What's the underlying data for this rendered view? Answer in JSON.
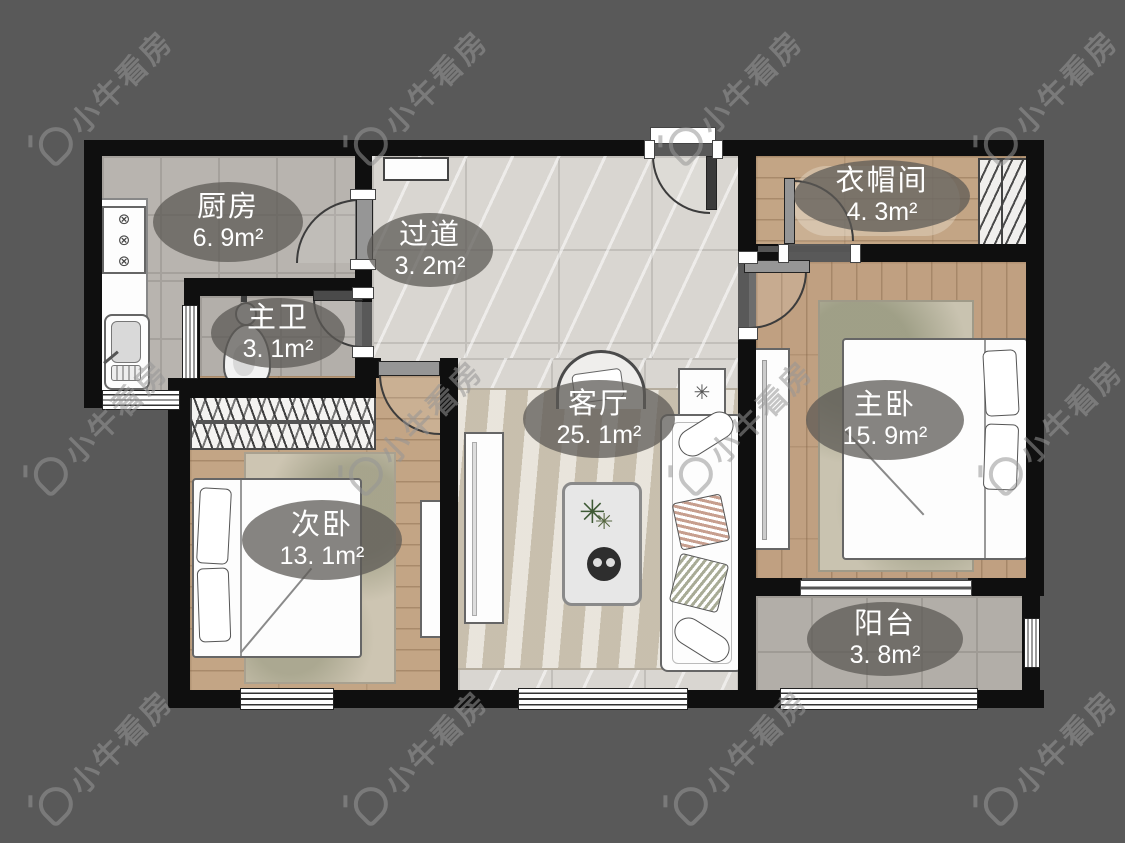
{
  "watermark": {
    "text": "小牛看房"
  },
  "rooms": [
    {
      "id": "kitchen",
      "name": "厨房",
      "area": "6. 9m²"
    },
    {
      "id": "hallway",
      "name": "过道",
      "area": "3. 2m²"
    },
    {
      "id": "master-bath",
      "name": "主卫",
      "area": "3. 1m²"
    },
    {
      "id": "cloakroom",
      "name": "衣帽间",
      "area": "4. 3m²"
    },
    {
      "id": "living-room",
      "name": "客厅",
      "area": "25. 1m²"
    },
    {
      "id": "master-bedroom",
      "name": "主卧",
      "area": "15. 9m²"
    },
    {
      "id": "second-bedroom",
      "name": "次卧",
      "area": "13. 1m²"
    },
    {
      "id": "balcony",
      "name": "阳台",
      "area": "3. 8m²"
    }
  ],
  "decor": {
    "coffee_table_plant": "✳",
    "flower_box": "✳",
    "stove_burner": "⊗"
  },
  "colors": {
    "background": "#595959",
    "wall": "#0f0f0f",
    "label_bubble": "rgba(92,89,85,0.74)",
    "label_text": "#ffffff",
    "kitchen_tile": "#b8b4af",
    "marble_floor": "#d9d6d1",
    "wood_floor": "#c2a384",
    "balcony_tile": "#b2aea8"
  }
}
